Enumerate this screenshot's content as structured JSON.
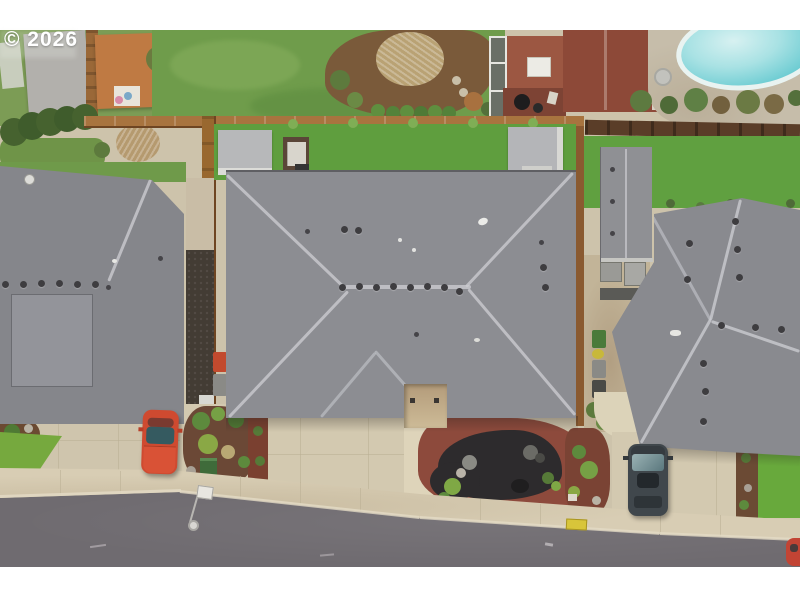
{
  "watermark": {
    "copyright": "© 2026"
  },
  "scene": {
    "type": "aerial-drone-photo",
    "description": "Top-down aerial drone photo of a residential neighborhood: a large gray hip-roof house centered between two neighboring gray-roof houses; backyards with bright lawns, two gray sheds and a hot tub behind the center home; neighboring yards above with an orange shed, a brick outbuilding, a rust-red roof and an oval swimming pool with tan deck at top right; cedar fences dividing lots; landscaped front yard with a kidney-shaped black lava-rock bed in red mulch; concrete driveways with a red car at left and a dark SUV at right; a curved asphalt street with sidewalk, curb and a street lamp along the bottom; white letterbox bands top and bottom with a © 2026 watermark.",
    "objects": [
      "watermark-text",
      "left-house-roof",
      "center-house-roof",
      "right-house-roof",
      "garage-roof",
      "backyard-lawn",
      "left-shed",
      "right-shed",
      "hot-tub",
      "top-fence",
      "side-fences",
      "dark-fence",
      "neighbor-lawn",
      "orange-shed",
      "gray-shed",
      "brick-shed",
      "greenhouse",
      "red-roof-outbuilding",
      "swimming-pool",
      "pool-deck",
      "patio-table",
      "shrub-row",
      "hedge-row",
      "dried-grass-clump",
      "rock-garden",
      "red-mulch-beds",
      "utility-box",
      "trash-bins",
      "ac-units",
      "entry-alcove",
      "left-driveway",
      "center-driveway",
      "right-driveway",
      "front-lawn-patches",
      "sidewalk",
      "curb",
      "street",
      "street-lamp",
      "yellow-marker",
      "red-car",
      "dark-suv",
      "red-car-edge",
      "satellite-dish"
    ],
    "palette": {
      "grass_bright": "#5f9e3e",
      "grass_muted": "#729a50",
      "roof_gray": "#8c8d92",
      "asphalt": "#6f6b70",
      "concrete": "#d2c8af",
      "sidewalk": "#d8cdb4",
      "mulch_red": "#8d4a3c",
      "lava_rock": "#2d2b2d",
      "fence_cedar": "#a8743f",
      "fence_dark": "#5a3d28",
      "pool_water": "#7fd2d6",
      "pool_deck": "#c6bdaa",
      "red_car": "#cf4a30",
      "suv_gray": "#40474c",
      "shed_orange": "#bf7a43",
      "brick_red": "#9c5742"
    }
  }
}
